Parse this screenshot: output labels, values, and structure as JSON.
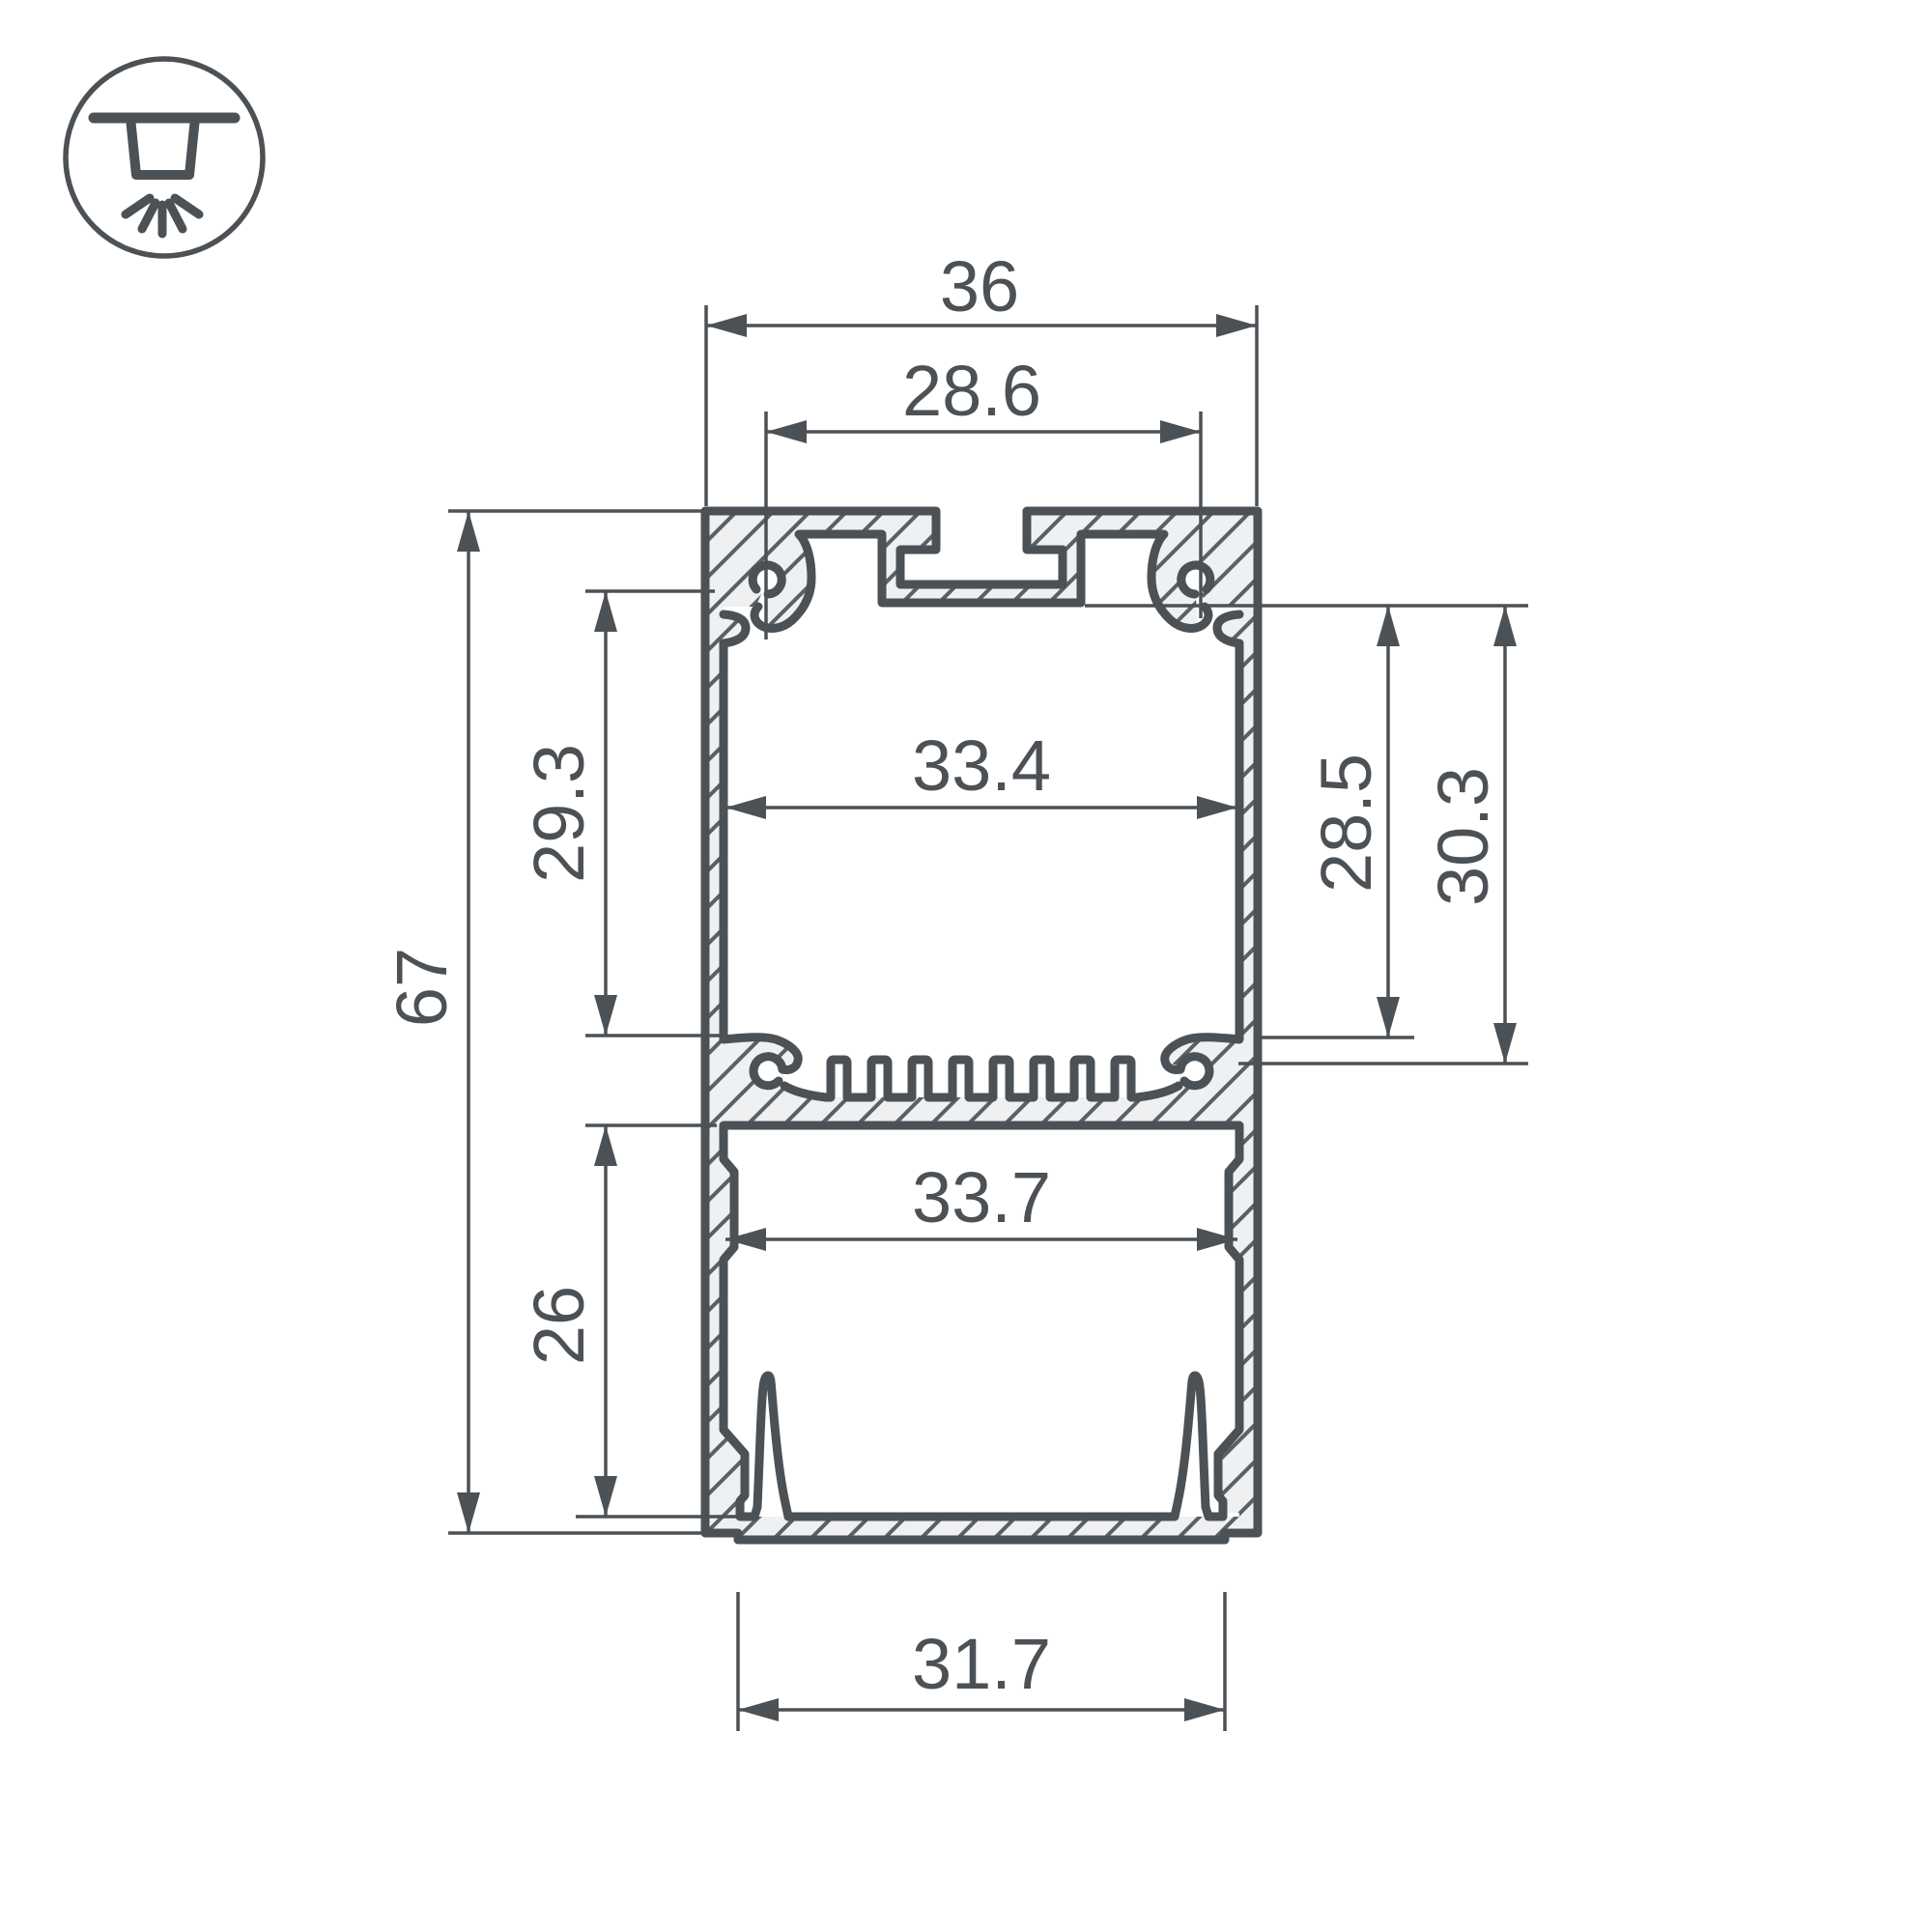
{
  "drawing": {
    "type": "profile-cross-section",
    "icon": "ceiling-light-icon",
    "colors": {
      "line": "#4c5156",
      "aluminum_fill": "#eff0f1",
      "hatch": "#5a6065",
      "background": "#ffffff"
    },
    "dimensions": {
      "total_width": "36",
      "slot_width": "28.6",
      "upper_inner_width": "33.4",
      "upper_inner_height": "29.3",
      "total_height": "67",
      "right_inner_height": "28.5",
      "right_outer_height": "30.3",
      "lower_inner_width": "33.7",
      "lower_inner_height": "26",
      "bottom_opening_width": "31.7"
    }
  }
}
